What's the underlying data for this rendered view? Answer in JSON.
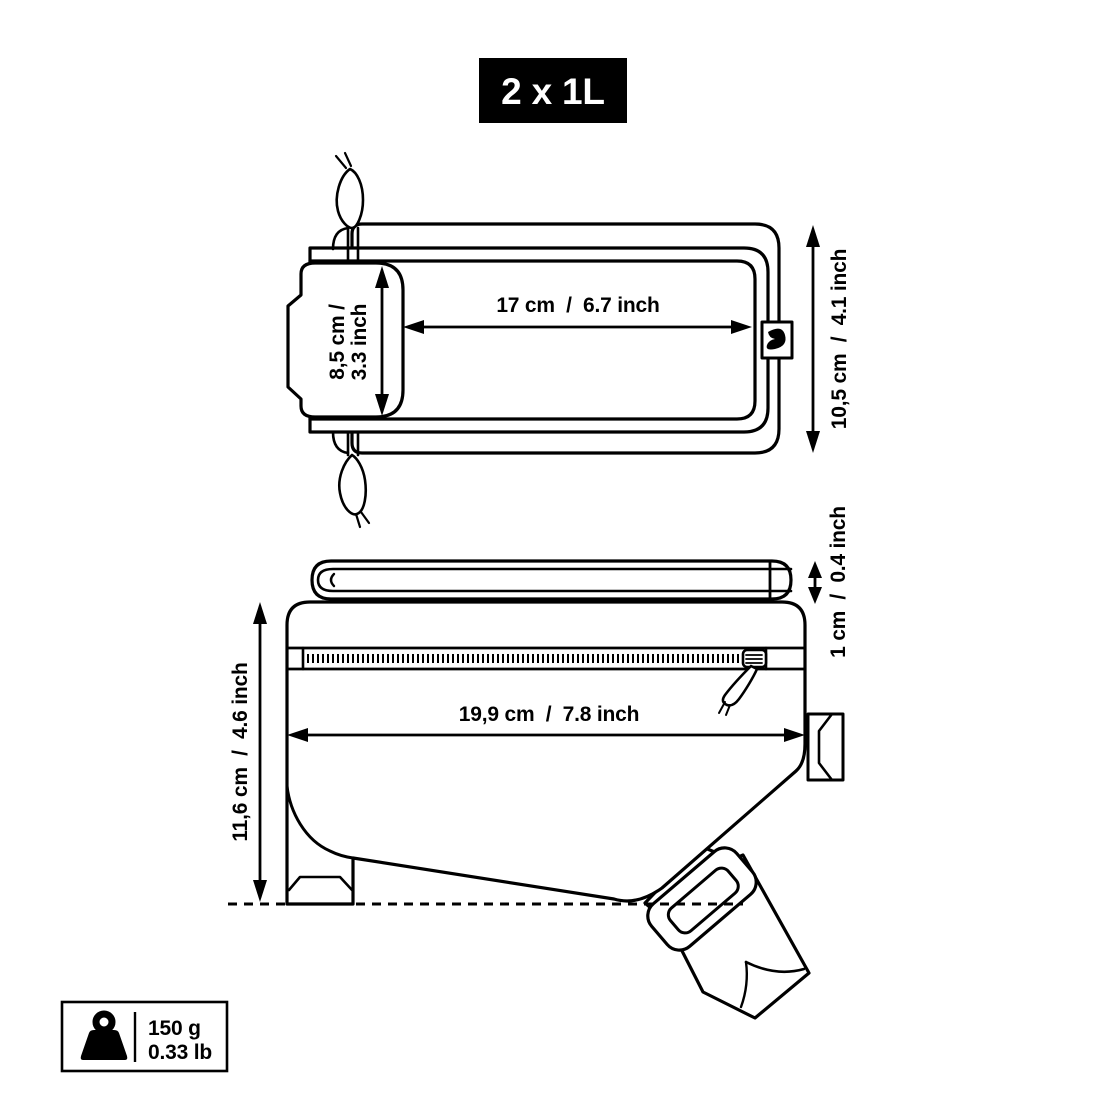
{
  "badge": {
    "label": "2 x 1L"
  },
  "top_view": {
    "name": "bag top view",
    "width_label": "17 cm  /  6.7 inch",
    "window_height_label_line1": "8,5 cm /",
    "window_height_label_line2": "3.3 inch",
    "depth_label": "10,5 cm  /  4.1 inch"
  },
  "side_view": {
    "name": "bag side view",
    "length_label": "19,9 cm  /  7.8 inch",
    "lid_thickness_label": "1 cm  /  0.4 inch",
    "height_label": "11,6 cm  /  4.6 inch"
  },
  "weight": {
    "grams_label": "150 g",
    "pounds_label": "0.33 lb"
  },
  "colors": {
    "line": "#000000",
    "background": "#ffffff",
    "badge_bg": "#000000",
    "badge_text": "#ffffff"
  }
}
